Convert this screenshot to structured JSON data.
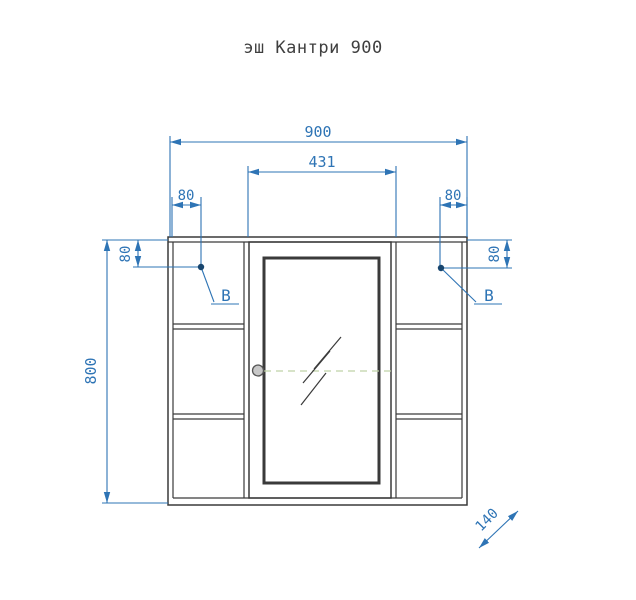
{
  "title": "эш Кантри 900",
  "drawing": {
    "dim_width_total": "900",
    "dim_door_width": "431",
    "dim_hook_left_horizontal": "80",
    "dim_hook_left_vertical": "80",
    "dim_hook_right_horizontal": "80",
    "dim_hook_right_vertical": "80",
    "dim_height_total": "800",
    "dim_depth": "140",
    "label_hook_left": "B",
    "label_hook_right": "B"
  },
  "colors": {
    "dimension_blue": "#2e74b5",
    "hook_dot_navy": "#17456e",
    "outline_dark": "#3a3a3a",
    "centerline_green": "#bfd2a6",
    "knob_gray": "#c8c8c8",
    "background": "#ffffff"
  }
}
